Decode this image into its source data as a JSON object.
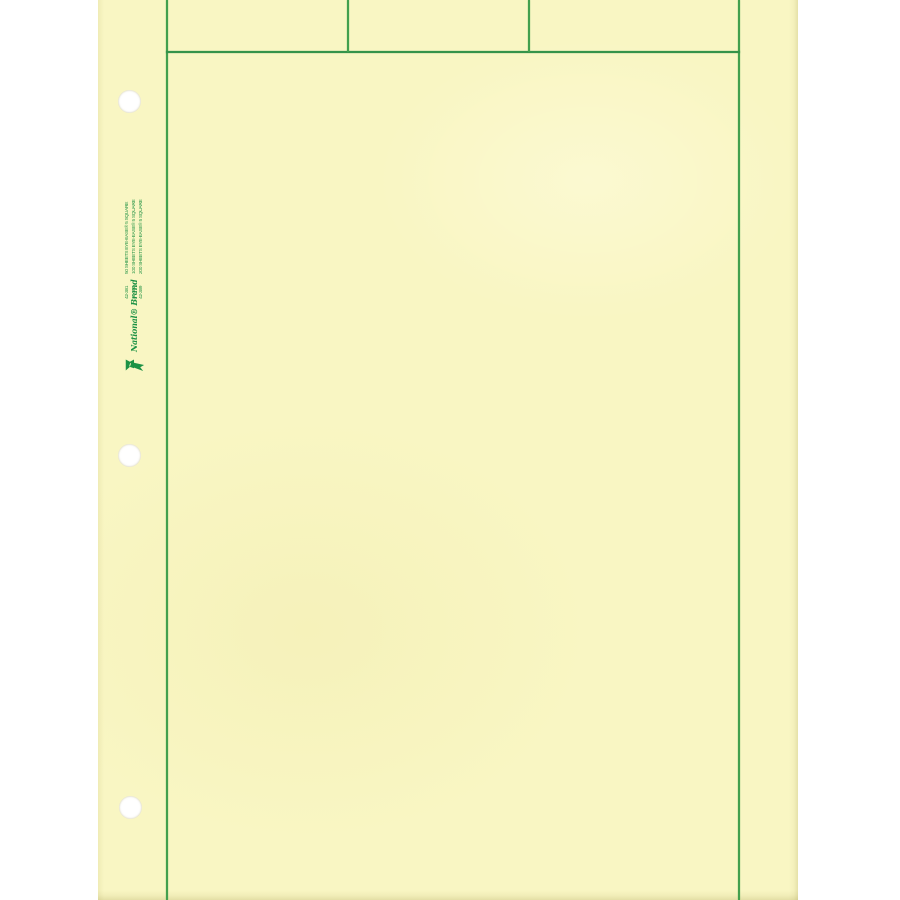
{
  "palette": {
    "background": "#ffffff",
    "paper": "#f9f6c3",
    "grid_line_green": "#43a04e",
    "print_green": "#1d9245"
  },
  "edge_print": {
    "brand": "National® Brand",
    "sheet_counts": [
      "50 SHEETS EYE-EASE® 5 SQUARE",
      "100 SHEETS EYE-EASE® 5 SQUARE",
      "200 SHEETS EYE-EASE® 5 SQUARE"
    ],
    "item_numbers": [
      "42-381",
      "42-382",
      "42-389"
    ]
  }
}
